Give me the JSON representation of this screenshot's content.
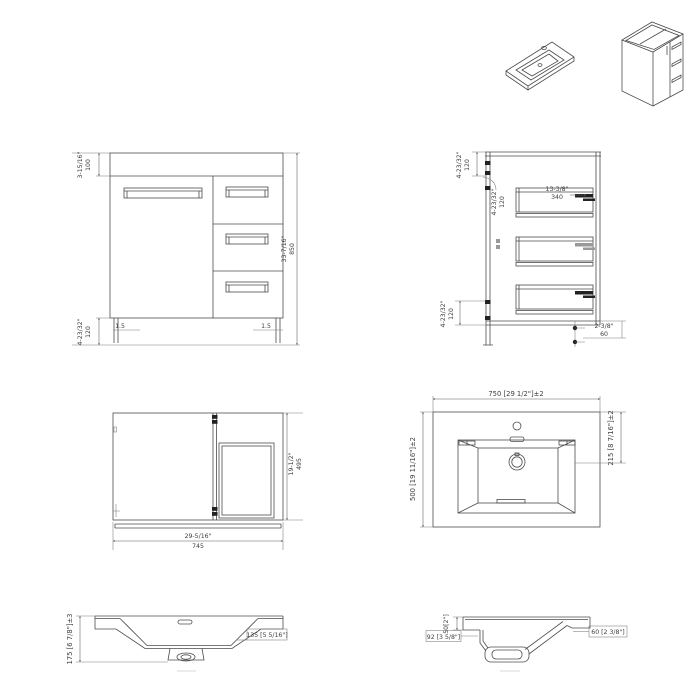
{
  "drawing": {
    "front": {
      "top_rail_in": "3-15/16\"",
      "top_rail_mm": "100",
      "toe_kick_in": "4-23/32\"",
      "toe_kick_mm": "120",
      "height_in": "33-7/16\"",
      "height_mm": "850",
      "left_reveal": "1.5",
      "right_reveal": "1.5"
    },
    "section": {
      "top_inset_in": "4-23/32\"",
      "top_inset_mm": "120",
      "inner_inset_in": "4-23/32\"",
      "inner_inset_mm": "120",
      "drawer_in": "13-3/8\"",
      "drawer_mm": "340",
      "bottom_inset_in": "4-23/32\"",
      "bottom_inset_mm": "120",
      "leg_in": "2-3/8\"",
      "leg_mm": "60"
    },
    "plan": {
      "width_in": "29-5/16\"",
      "width_mm": "745",
      "depth_in": "19-1/2\"",
      "depth_mm": "495"
    },
    "sink_top": {
      "width": "750 [29 1/2\"]±2",
      "depth": "500 [19 11/16\"]±2",
      "drain": "215 [8 7/16\"]±2"
    },
    "sink_front": {
      "height": "175 [6 7/8\"]±3",
      "apron": "135 [5 5/16\"]"
    },
    "sink_side": {
      "rim": "50[2\"]",
      "front": "92 [3 5/8\"]",
      "back": "60 [2 3/8\"]"
    }
  }
}
